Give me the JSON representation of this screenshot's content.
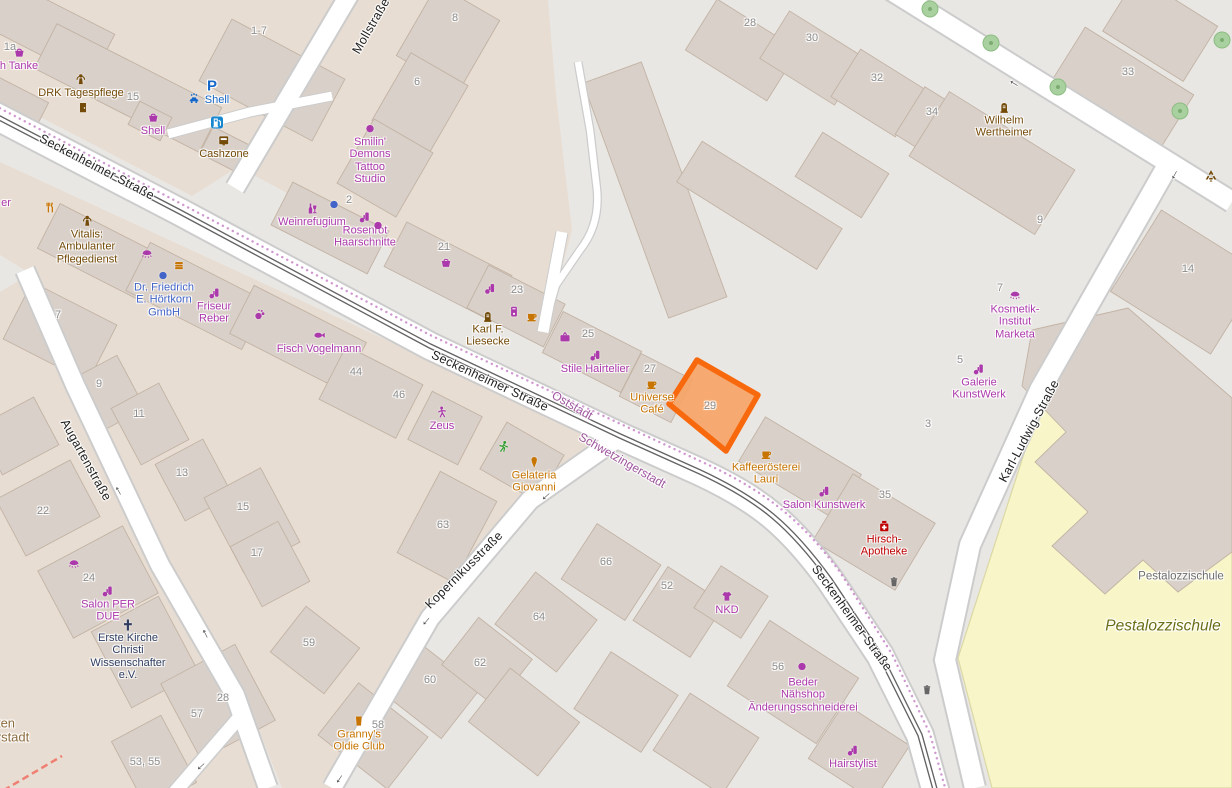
{
  "canvas": {
    "width": 1232,
    "height": 788
  },
  "colors": {
    "shop": "#ac39ac",
    "food": "#c77400",
    "amenity": "#734a08",
    "office": "#4264c8",
    "fuel_blue": "#1467c8",
    "health_red": "#bf0000",
    "worship": "#2f3e62",
    "housenumber": "#8d8d8d",
    "street": "#1f1f1f",
    "district": "#9e559e",
    "district_brown": "#8c6d3f",
    "school_area": "#6b6e16",
    "school_building": "#6e6e6e",
    "arrow": "#4a4a4a",
    "icon_gray": "#666666",
    "green": "#2f9e2f",
    "land": "#e9e7e4",
    "block": "#e8ddd2",
    "building": "#d9d0c9",
    "building_line": "#c2b3a4",
    "road": "#ffffff",
    "road_casing": "#cccccc",
    "tram": "#636363",
    "boundary": "#c887c8",
    "school_fill": "#f8f6c8",
    "highlight_stroke": "#f8680c",
    "highlight_fill": "#f6a466",
    "tree": "#a9d1a0",
    "red_dash": "#ef7f72"
  },
  "highlighted_building": {
    "housenumber": "29"
  },
  "map_labels": [
    {
      "n": "street-label-seckenheimer-nw",
      "t": "Seckenheimer Straße",
      "x": 97,
      "y": 167,
      "r": 27.5,
      "c": "street",
      "s": 12.5
    },
    {
      "n": "street-label-seckenheimer-mid",
      "t": "Seckenheimer Straße",
      "x": 490,
      "y": 381,
      "r": 25,
      "c": "street",
      "s": 12.5
    },
    {
      "n": "street-label-seckenheimer-se",
      "t": "Seckenheimer Straße",
      "x": 852,
      "y": 618,
      "r": 54,
      "c": "street",
      "s": 12.5
    },
    {
      "n": "street-label-mollstrasse",
      "t": "Mollstraße",
      "x": 371,
      "y": 26,
      "r": -60,
      "c": "street",
      "s": 12.5
    },
    {
      "n": "street-label-augartenstrasse",
      "t": "Augartenstraße",
      "x": 86,
      "y": 460,
      "r": 61,
      "c": "street",
      "s": 12.5
    },
    {
      "n": "street-label-kopernikusstrasse",
      "t": "Kopernikusstraße",
      "x": 464,
      "y": 570,
      "r": -45,
      "c": "street",
      "s": 12.5
    },
    {
      "n": "street-label-karl-ludwig-strasse",
      "t": "Karl-Ludwig-Straße",
      "x": 1029,
      "y": 431,
      "r": -62,
      "c": "street",
      "s": 12.5
    },
    {
      "n": "district-label-oststadt",
      "t": "Oststadt",
      "x": 572,
      "y": 406,
      "r": 30,
      "c": "district",
      "s": 12
    },
    {
      "n": "district-label-schwetzingerstadt",
      "t": "Schwetzingerstadt",
      "x": 622,
      "y": 461,
      "r": 30,
      "c": "district",
      "s": 12
    },
    {
      "n": "district-label-partial-1",
      "t": "ten",
      "x": 6,
      "y": 724,
      "c": "district_brown",
      "s": 13
    },
    {
      "n": "district-label-partial-2",
      "t": "rstadt",
      "x": 13,
      "y": 738,
      "c": "district_brown",
      "s": 13
    },
    {
      "n": "school-name-label",
      "t": "Pestalozzischule",
      "x": 1181,
      "y": 577,
      "c": "school_building",
      "s": 11.5
    },
    {
      "n": "school-area-label",
      "t": "Pestalozzischule",
      "x": 1163,
      "y": 626,
      "c": "school_area",
      "s": 15.5,
      "it": 1
    },
    {
      "n": "hn-1a",
      "t": "1a",
      "x": 10,
      "y": 47,
      "c": "housenumber"
    },
    {
      "n": "poi-tanke-partial",
      "t": "h Tanke",
      "i": "basket",
      "x": 19,
      "y": 59,
      "c": "shop"
    },
    {
      "n": "poi-drk-tagespflege",
      "t": "DRK Tagespflege",
      "i": "person-care",
      "x": 81,
      "y": 86,
      "c": "amenity"
    },
    {
      "n": "icon-drk-door",
      "i": "door",
      "x": 83,
      "y": 108,
      "c": "amenity"
    },
    {
      "n": "hn-15",
      "t": "15",
      "x": 133,
      "y": 97,
      "c": "housenumber"
    },
    {
      "n": "poi-shell-shop",
      "t": "Shell",
      "i": "basket",
      "x": 153,
      "y": 124,
      "c": "shop"
    },
    {
      "n": "parking-icon",
      "t": "P",
      "x": 212,
      "y": 87,
      "c": "fuel_blue",
      "s": 15,
      "b": 1
    },
    {
      "n": "carwash-icon",
      "i": "carwash",
      "x": 194,
      "y": 99,
      "c": "fuel_blue"
    },
    {
      "n": "poi-shell-fuel",
      "t": "Shell",
      "x": 217,
      "y": 100,
      "c": "fuel_blue"
    },
    {
      "n": "fuel-icon",
      "i": "fuel",
      "x": 217,
      "y": 123,
      "is": 15
    },
    {
      "n": "poi-cashzone",
      "t": "Cashzone",
      "i": "atm",
      "x": 224,
      "y": 147,
      "c": "amenity"
    },
    {
      "n": "hn-1-7",
      "t": "1-7",
      "x": 259,
      "y": 31,
      "c": "housenumber"
    },
    {
      "n": "hn-8",
      "t": "8",
      "x": 455,
      "y": 18,
      "c": "housenumber"
    },
    {
      "n": "hn-6",
      "t": "6",
      "x": 417,
      "y": 82,
      "c": "housenumber"
    },
    {
      "n": "poi-smilin-demons",
      "t": "Smilin'\nDemons\nTattoo\nStudio",
      "i": "dot",
      "x": 370,
      "y": 154,
      "c": "shop"
    },
    {
      "n": "hn-2",
      "t": "2",
      "x": 349,
      "y": 200,
      "c": "housenumber"
    },
    {
      "n": "dot-weinrefugium-blue",
      "i": "dot",
      "x": 334,
      "y": 205,
      "c": "office"
    },
    {
      "n": "poi-weinrefugium",
      "t": "Weinrefugium",
      "i": "wine",
      "x": 312,
      "y": 215,
      "c": "shop"
    },
    {
      "n": "poi-rosenrot",
      "t": "Rosenrot\nHaarschnitte",
      "i": "hairdresser",
      "x": 365,
      "y": 230,
      "c": "shop"
    },
    {
      "n": "dot-rosenrot",
      "i": "dot",
      "x": 378,
      "y": 226,
      "c": "shop"
    },
    {
      "n": "hn-21",
      "t": "21",
      "x": 444,
      "y": 247,
      "c": "housenumber"
    },
    {
      "n": "basket-icon-21",
      "i": "basket",
      "x": 446,
      "y": 263,
      "c": "shop"
    },
    {
      "n": "hairdresser-icon-23",
      "i": "hairdresser",
      "x": 490,
      "y": 289,
      "c": "shop"
    },
    {
      "n": "hn-23",
      "t": "23",
      "x": 517,
      "y": 290,
      "c": "housenumber"
    },
    {
      "n": "vending-icon",
      "i": "vending",
      "x": 514,
      "y": 312,
      "c": "shop"
    },
    {
      "n": "cup-icon-23",
      "i": "cup",
      "x": 532,
      "y": 317,
      "c": "food"
    },
    {
      "n": "poi-karl-liesecke",
      "t": "Karl F.\nLiesecke",
      "i": "memorial",
      "x": 488,
      "y": 329,
      "c": "amenity"
    },
    {
      "n": "hn-25",
      "t": "25",
      "x": 588,
      "y": 334,
      "c": "housenumber"
    },
    {
      "n": "tv-icon",
      "i": "tv",
      "x": 565,
      "y": 338,
      "c": "shop"
    },
    {
      "n": "poi-stile-hairtelier",
      "t": "Stile Hairtelier",
      "i": "hairdresser",
      "x": 595,
      "y": 362,
      "c": "shop"
    },
    {
      "n": "hn-27",
      "t": "27",
      "x": 650,
      "y": 369,
      "c": "housenumber"
    },
    {
      "n": "poi-universe-cafe",
      "t": "Universe\nCafé",
      "i": "cup",
      "x": 652,
      "y": 397,
      "c": "food"
    },
    {
      "n": "hn-29",
      "t": "29",
      "x": 710,
      "y": 406,
      "c": "housenumber"
    },
    {
      "n": "poi-kaffeeroesterei-lauri",
      "t": "Kaffeerösterei\nLauri",
      "i": "cup",
      "x": 766,
      "y": 467,
      "c": "food"
    },
    {
      "n": "poi-salon-kunstwerk",
      "t": "Salon Kunstwerk",
      "i": "hairdresser",
      "x": 824,
      "y": 498,
      "c": "shop"
    },
    {
      "n": "hn-35",
      "t": "35",
      "x": 885,
      "y": 495,
      "c": "housenumber"
    },
    {
      "n": "poi-hirsch-apotheke",
      "t": "Hirsch-\nApotheke",
      "i": "pharmacy",
      "x": 884,
      "y": 539,
      "c": "health_red"
    },
    {
      "n": "hn-28",
      "t": "28",
      "x": 750,
      "y": 23,
      "c": "housenumber"
    },
    {
      "n": "hn-30",
      "t": "30",
      "x": 812,
      "y": 38,
      "c": "housenumber"
    },
    {
      "n": "hn-32",
      "t": "32",
      "x": 877,
      "y": 78,
      "c": "housenumber"
    },
    {
      "n": "hn-34",
      "t": "34",
      "x": 932,
      "y": 112,
      "c": "housenumber"
    },
    {
      "n": "hn-33",
      "t": "33",
      "x": 1128,
      "y": 72,
      "c": "housenumber"
    },
    {
      "n": "poi-wilhelm-wertheimer",
      "t": "Wilhelm\nWertheimer",
      "i": "memorial",
      "x": 1004,
      "y": 120,
      "c": "amenity"
    },
    {
      "n": "recycling-icon",
      "i": "recycle",
      "x": 1211,
      "y": 177,
      "c": "amenity"
    },
    {
      "n": "hn-14",
      "t": "14",
      "x": 1188,
      "y": 269,
      "c": "housenumber"
    },
    {
      "n": "hn-9-ne",
      "t": "9",
      "x": 1040,
      "y": 220,
      "c": "housenumber"
    },
    {
      "n": "hn-7-ne",
      "t": "7",
      "x": 1000,
      "y": 288,
      "c": "housenumber"
    },
    {
      "n": "poi-kosmetik-marketa",
      "t": "Kosmetik-\nInstitut\nMarketa",
      "i": "eyelash",
      "x": 1015,
      "y": 315,
      "c": "shop"
    },
    {
      "n": "hn-5-ne",
      "t": "5",
      "x": 960,
      "y": 360,
      "c": "housenumber"
    },
    {
      "n": "poi-galerie-kunstwerk",
      "t": "Galerie\nKunstWerk",
      "i": "hairdresser",
      "x": 979,
      "y": 382,
      "c": "shop"
    },
    {
      "n": "hn-3-ne",
      "t": "3",
      "x": 928,
      "y": 424,
      "c": "housenumber"
    },
    {
      "n": "fork-knife-icon",
      "i": "forkknife",
      "x": 50,
      "y": 208,
      "c": "food"
    },
    {
      "n": "poi-partial-er",
      "t": "er",
      "x": 6,
      "y": 203,
      "c": "shop"
    },
    {
      "n": "poi-vitalis",
      "t": "Vitalis:\nAmbulanter\nPflegedienst",
      "i": "person-care",
      "x": 87,
      "y": 240,
      "c": "amenity"
    },
    {
      "n": "eyelash-icon-1",
      "i": "eyelash",
      "x": 147,
      "y": 255,
      "c": "shop"
    },
    {
      "n": "burger-icon",
      "i": "burger",
      "x": 179,
      "y": 266,
      "c": "food"
    },
    {
      "n": "dot-hoertkorn-blue",
      "i": "dot",
      "x": 163,
      "y": 276,
      "c": "office"
    },
    {
      "n": "poi-hoertkorn",
      "t": "Dr. Friedrich\nE. Hörtkorn\nGmbH",
      "x": 164,
      "y": 300,
      "c": "office"
    },
    {
      "n": "poi-friseur-reber",
      "t": "Friseur\nReber",
      "i": "hairdresser",
      "x": 214,
      "y": 306,
      "c": "shop"
    },
    {
      "n": "massage-icon",
      "i": "massage",
      "x": 260,
      "y": 315,
      "c": "shop"
    },
    {
      "n": "hn-7-w",
      "t": "7",
      "x": 58,
      "y": 315,
      "c": "housenumber"
    },
    {
      "n": "poi-fisch-vogelmann",
      "t": "Fisch Vogelmann",
      "i": "fish",
      "x": 319,
      "y": 342,
      "c": "shop"
    },
    {
      "n": "hn-44",
      "t": "44",
      "x": 356,
      "y": 372,
      "c": "housenumber"
    },
    {
      "n": "hn-46",
      "t": "46",
      "x": 399,
      "y": 395,
      "c": "housenumber"
    },
    {
      "n": "poi-zeus",
      "t": "Zeus",
      "i": "dancer",
      "x": 442,
      "y": 419,
      "c": "shop"
    },
    {
      "n": "runner-icon",
      "i": "runner",
      "x": 503,
      "y": 447,
      "c": "green"
    },
    {
      "n": "poi-gelateria-giovanni",
      "t": "Gelateria\nGiovanni",
      "i": "icecream",
      "x": 534,
      "y": 475,
      "c": "food"
    },
    {
      "n": "hn-63",
      "t": "63",
      "x": 443,
      "y": 525,
      "c": "housenumber"
    },
    {
      "n": "hn-9-aug",
      "t": "9",
      "x": 99,
      "y": 384,
      "c": "housenumber"
    },
    {
      "n": "hn-11",
      "t": "11",
      "x": 139,
      "y": 414,
      "c": "housenumber"
    },
    {
      "n": "hn-13",
      "t": "13",
      "x": 182,
      "y": 473,
      "c": "housenumber"
    },
    {
      "n": "hn-15-aug",
      "t": "15",
      "x": 243,
      "y": 507,
      "c": "housenumber"
    },
    {
      "n": "hn-17",
      "t": "17",
      "x": 257,
      "y": 553,
      "c": "housenumber"
    },
    {
      "n": "hn-22",
      "t": "22",
      "x": 43,
      "y": 511,
      "c": "housenumber"
    },
    {
      "n": "eyelash-icon-2",
      "i": "eyelash",
      "x": 74,
      "y": 565,
      "c": "shop"
    },
    {
      "n": "hn-24",
      "t": "24",
      "x": 89,
      "y": 578,
      "c": "housenumber"
    },
    {
      "n": "poi-salon-per-due",
      "t": "Salon PER\nDUE",
      "i": "hairdresser",
      "x": 108,
      "y": 604,
      "c": "shop"
    },
    {
      "n": "poi-erste-kirche",
      "t": "Erste Kirche\nChristi\nWissenschafter\ne.V.",
      "i": "cross",
      "x": 128,
      "y": 650,
      "c": "worship"
    },
    {
      "n": "hn-57",
      "t": "57",
      "x": 197,
      "y": 714,
      "c": "housenumber"
    },
    {
      "n": "hn-28-sw",
      "t": "28",
      "x": 223,
      "y": 698,
      "c": "housenumber"
    },
    {
      "n": "hn-53-55",
      "t": "53, 55",
      "x": 145,
      "y": 762,
      "c": "housenumber"
    },
    {
      "n": "hn-59",
      "t": "59",
      "x": 309,
      "y": 643,
      "c": "housenumber"
    },
    {
      "n": "hn-60",
      "t": "60",
      "x": 430,
      "y": 680,
      "c": "housenumber"
    },
    {
      "n": "hn-62",
      "t": "62",
      "x": 480,
      "y": 663,
      "c": "housenumber"
    },
    {
      "n": "hn-64",
      "t": "64",
      "x": 539,
      "y": 617,
      "c": "housenumber"
    },
    {
      "n": "poi-grannys-oldie-club",
      "t": "Granny's\nOldie Club",
      "i": "beer",
      "x": 359,
      "y": 734,
      "c": "food"
    },
    {
      "n": "hn-58",
      "t": "58",
      "x": 378,
      "y": 725,
      "c": "housenumber"
    },
    {
      "n": "hn-66",
      "t": "66",
      "x": 606,
      "y": 562,
      "c": "housenumber"
    },
    {
      "n": "hn-52",
      "t": "52",
      "x": 667,
      "y": 586,
      "c": "housenumber"
    },
    {
      "n": "poi-nkd",
      "t": "NKD",
      "i": "tshirt",
      "x": 727,
      "y": 603,
      "c": "shop"
    },
    {
      "n": "hn-56",
      "t": "56",
      "x": 778,
      "y": 667,
      "c": "housenumber"
    },
    {
      "n": "dot-beder",
      "i": "dot",
      "x": 802,
      "y": 667,
      "c": "shop"
    },
    {
      "n": "poi-beder",
      "t": "Beder\nNähshop\nÄnderungsschneiderei",
      "x": 803,
      "y": 695,
      "c": "shop"
    },
    {
      "n": "poi-hairstylist",
      "t": "Hairstylist",
      "i": "hairdresser",
      "x": 853,
      "y": 757,
      "c": "shop"
    },
    {
      "n": "trash-icon-1",
      "i": "trash",
      "x": 894,
      "y": 582,
      "c": "icon_gray"
    },
    {
      "n": "trash-icon-2",
      "i": "trash",
      "x": 927,
      "y": 690,
      "c": "icon_gray"
    },
    {
      "n": "oneway-arrow-ne-street",
      "t": "←",
      "x": 1015,
      "y": 82,
      "r": 32,
      "c": "arrow",
      "s": 14,
      "b": 1
    },
    {
      "n": "oneway-arrow-karl-ludwig",
      "t": "←",
      "x": 1173,
      "y": 174,
      "r": -62,
      "c": "arrow",
      "s": 14,
      "b": 1
    },
    {
      "n": "oneway-arrow-kopernikus-1",
      "t": "←",
      "x": 545,
      "y": 495,
      "r": -42,
      "c": "arrow",
      "s": 14,
      "b": 1
    },
    {
      "n": "oneway-arrow-kopernikus-2",
      "t": "←",
      "x": 425,
      "y": 620,
      "r": -49,
      "c": "arrow",
      "s": 14,
      "b": 1
    },
    {
      "n": "oneway-arrow-kopernikus-3",
      "t": "←",
      "x": 338,
      "y": 778,
      "r": -57,
      "c": "arrow",
      "s": 14,
      "b": 1
    },
    {
      "n": "oneway-arrow-augarten-1",
      "t": "←",
      "x": 120,
      "y": 490,
      "r": 60,
      "c": "arrow",
      "s": 14,
      "b": 1
    },
    {
      "n": "oneway-arrow-augarten-2",
      "t": "←",
      "x": 207,
      "y": 633,
      "r": 63,
      "c": "arrow",
      "s": 14,
      "b": 1
    },
    {
      "n": "oneway-arrow-branch",
      "t": "←",
      "x": 200,
      "y": 765,
      "r": -42,
      "c": "arrow",
      "s": 14,
      "b": 1
    }
  ]
}
